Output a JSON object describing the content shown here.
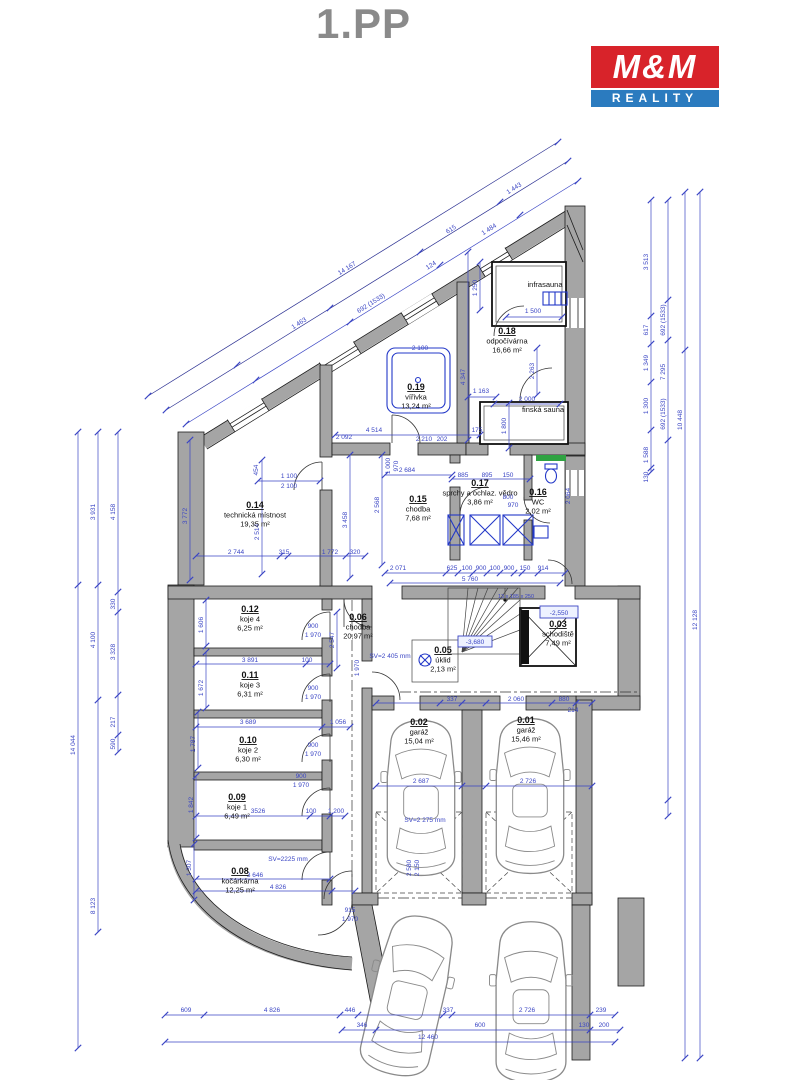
{
  "header": {
    "title": "1.PP"
  },
  "logo": {
    "line1": "M&M",
    "line2": "REALITY"
  },
  "colors": {
    "dimension_blue": "#3a45c4",
    "dimension_navy": "#2c3192",
    "wall_gray": "#a5a5a5",
    "fixture_blue": "#2338c8",
    "window_green": "#2fa342",
    "logo_red": "#d8232a",
    "logo_blue": "#2b7bbf",
    "title_gray": "#8a8a8a"
  },
  "rooms": [
    {
      "number": "0.01",
      "name": "garáž",
      "area": "15,46 m²"
    },
    {
      "number": "0.02",
      "name": "garáž",
      "area": "15,04 m²"
    },
    {
      "number": "0.03",
      "name": "schodiště",
      "area": "7,49 m²"
    },
    {
      "number": "0.05",
      "name": "úklid",
      "area": "2,13 m²"
    },
    {
      "number": "0.06",
      "name": "chodba",
      "area": "20,97 m²"
    },
    {
      "number": "0.08",
      "name": "kočárkárna",
      "area": "12,25 m²"
    },
    {
      "number": "0.09",
      "name": "koje 1",
      "area": "6,49 m²"
    },
    {
      "number": "0.10",
      "name": "koje 2",
      "area": "6,30 m²"
    },
    {
      "number": "0.11",
      "name": "koje 3",
      "area": "6,31 m²"
    },
    {
      "number": "0.12",
      "name": "koje 4",
      "area": "6,25 m²"
    },
    {
      "number": "0.14",
      "name": "technická místnost",
      "area": "19,35 m²"
    },
    {
      "number": "0.15",
      "name": "chodba",
      "area": "7,68 m²"
    },
    {
      "number": "0.16",
      "name": "WC",
      "area": "2,02 m²"
    },
    {
      "number": "0.17",
      "name": "sprchy a ochlaz. vědro",
      "area": "3,86 m²"
    },
    {
      "number": "0.18",
      "name": "odpočívárna",
      "area": "16,66 m²"
    },
    {
      "number": "0.19",
      "name": "vířivka",
      "area": "13,24 m²"
    }
  ],
  "saunas": {
    "infrasauna": "infrasauna",
    "finska": "finská sauna"
  },
  "levels": {
    "stair": "-2,550",
    "shaft": "-3,680"
  },
  "stair_note": "13 x 185 x 250",
  "heights": {
    "koje": "SV=2225 mm",
    "garage": "SV=2 275 mm",
    "chodba": "SV=2 405 mm"
  },
  "dims": [
    "14 167",
    "1 463",
    "615",
    "1 443",
    "692 (1533)",
    "124",
    "1 484",
    "3 513",
    "617",
    "1 349",
    "1 300",
    "1 588",
    "130",
    "692 (1533)",
    "7 295",
    "692 (1533)",
    "10 448",
    "12 128",
    "3 931",
    "4 158",
    "4 100",
    "3 328",
    "330",
    "217",
    "590",
    "14 044",
    "8 123",
    "609",
    "4 826",
    "446",
    "337",
    "2 726",
    "239",
    "346",
    "600",
    "130",
    "200",
    "12 460",
    "1 500",
    "1 250",
    "2 000",
    "1 800",
    "1 163",
    "2 263",
    "4 347",
    "2 100",
    "4 514",
    "175",
    "2 092",
    "2 210",
    "202",
    "1 100",
    "2 100",
    "454",
    "3 772",
    "2 514",
    "2 744",
    "315",
    "1 772",
    "320",
    "3 458",
    "2 568",
    "2 684",
    "1 000",
    "970",
    "885",
    "895",
    "150",
    "800",
    "970",
    "2 064",
    "2 071",
    "625",
    "100",
    "900",
    "100",
    "900",
    "150",
    "914",
    "5 760",
    "900",
    "1 970",
    "900",
    "1 970",
    "900",
    "1 970",
    "900",
    "1 970",
    "3 891",
    "100",
    "3 689",
    "1 056",
    "3526",
    "100",
    "1 200",
    "3 646",
    "4 826",
    "1 606",
    "1 672",
    "1 787",
    "1 842",
    "1 307",
    "337",
    "2 060",
    "880",
    "214",
    "2 687",
    "2 726",
    "2 580",
    "2 150",
    "915",
    "1 970",
    "2 547",
    "1 970"
  ]
}
